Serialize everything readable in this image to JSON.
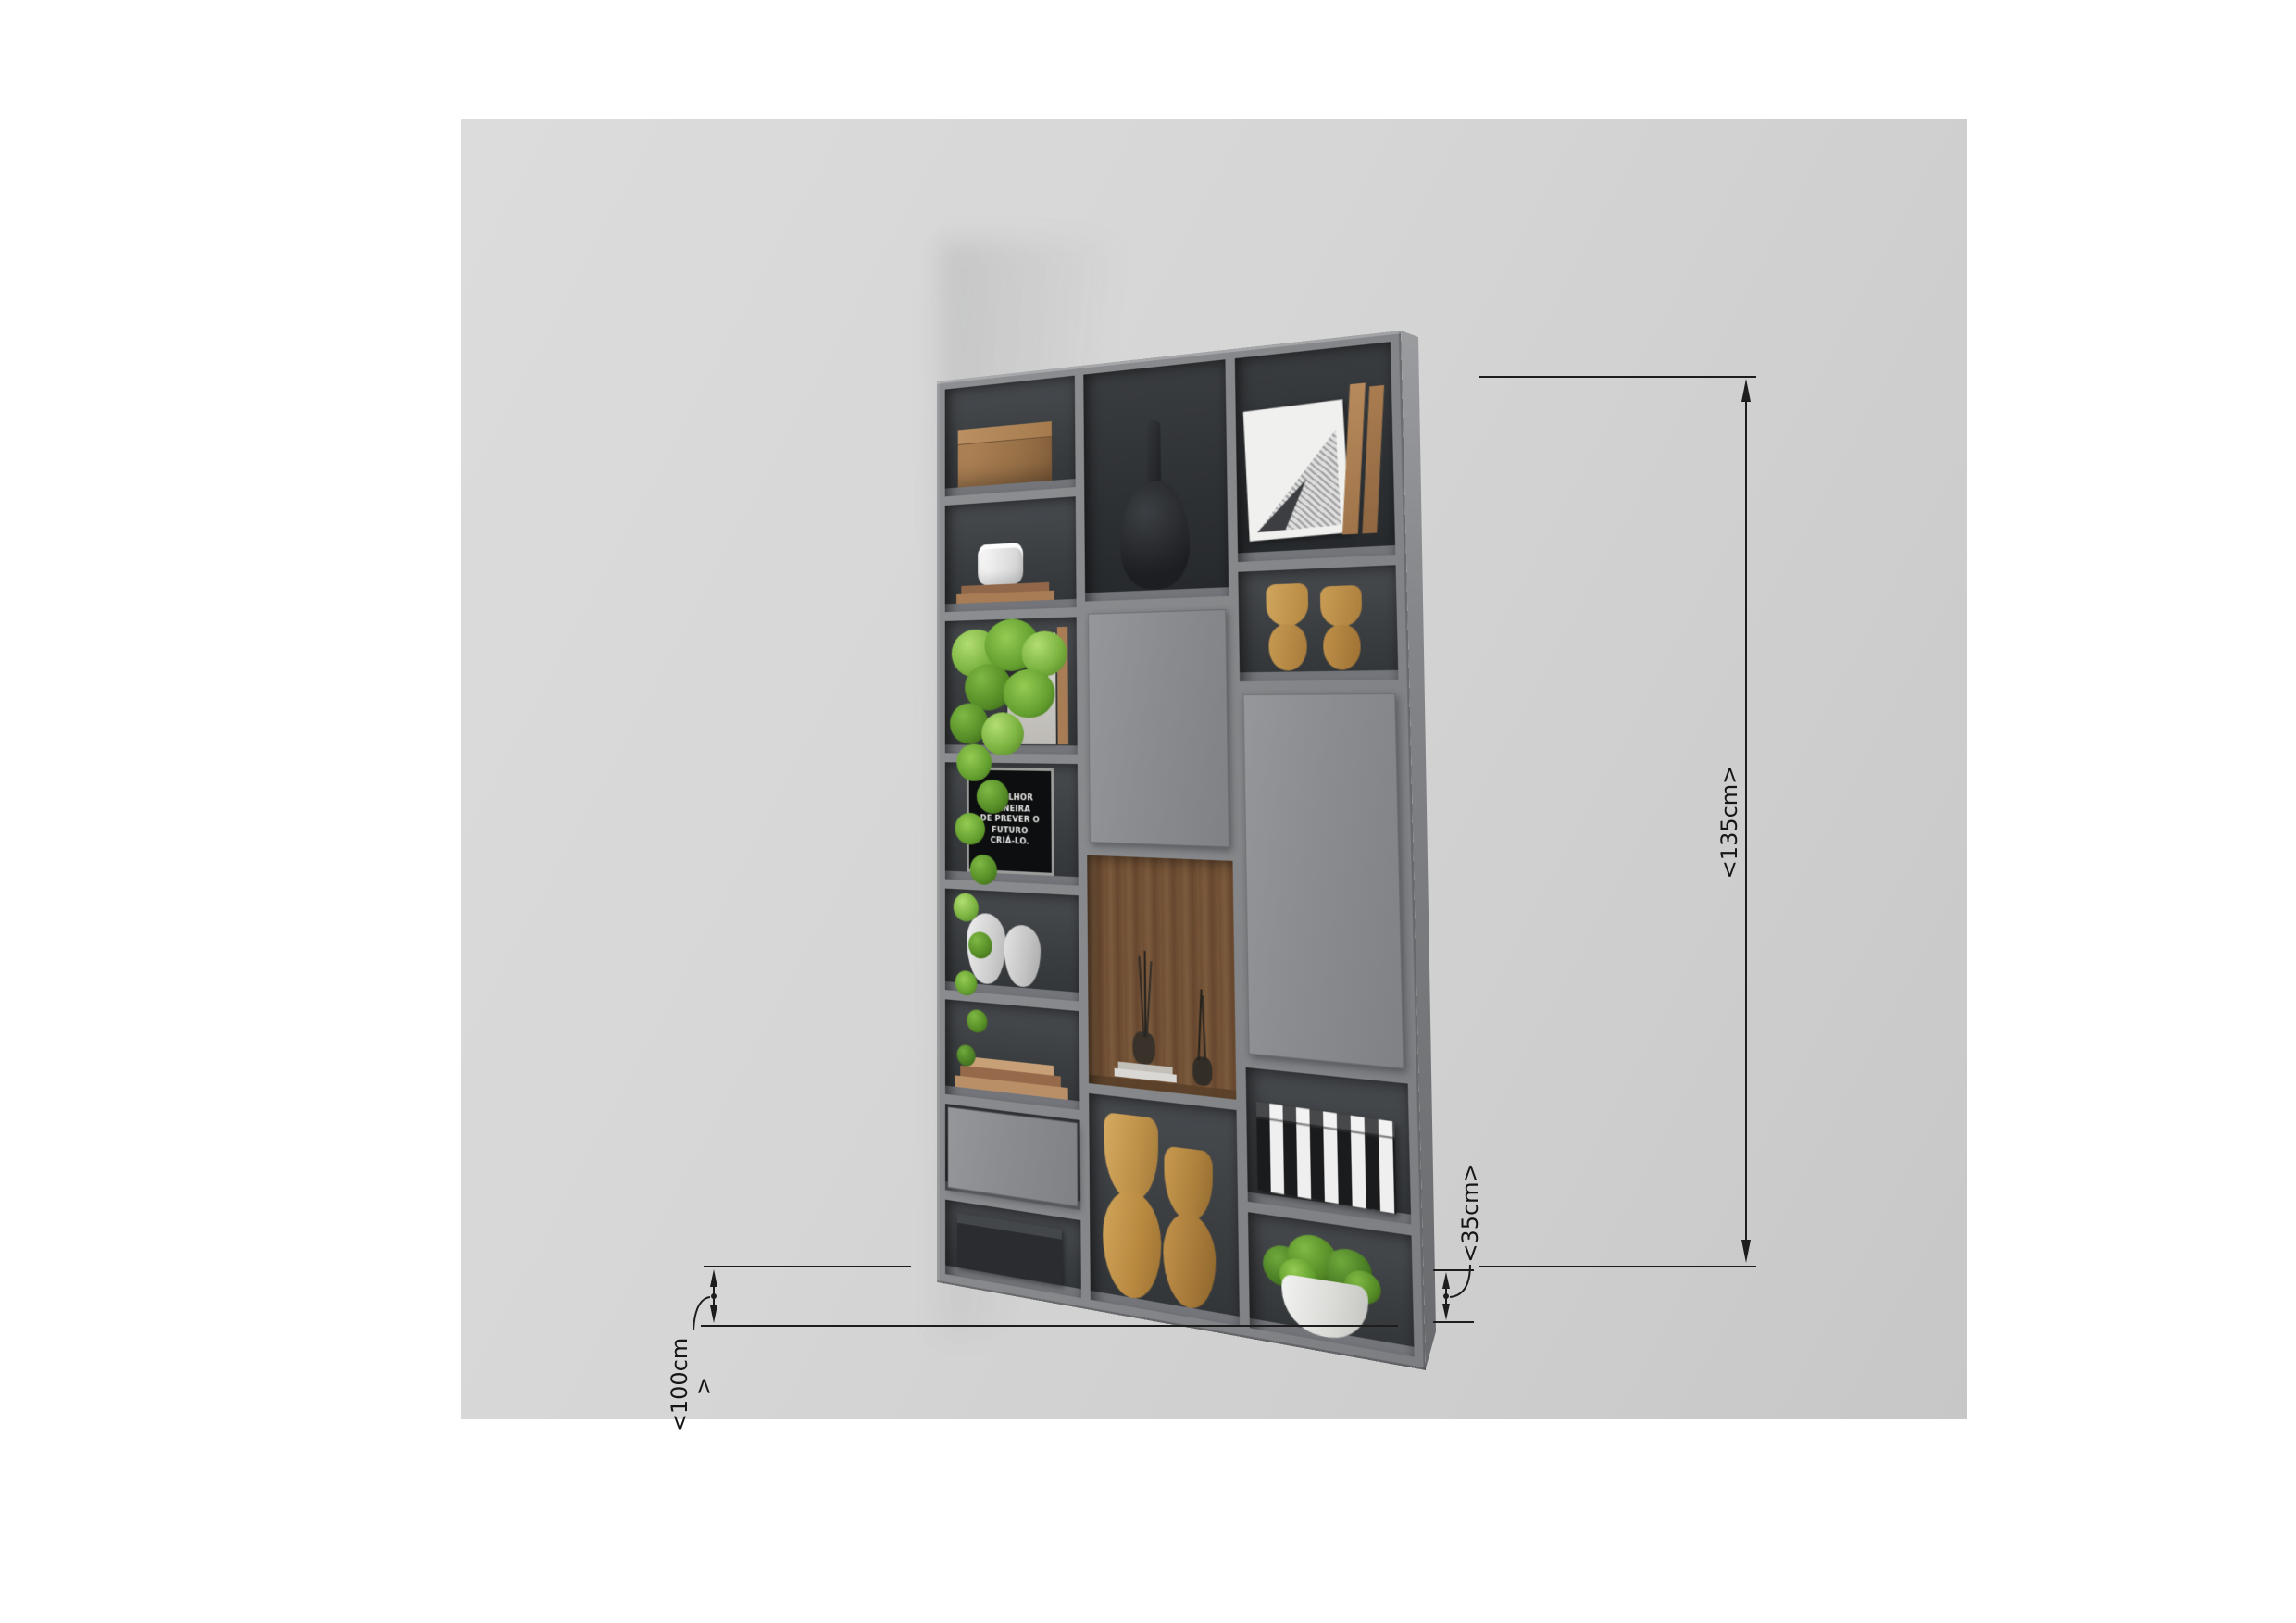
{
  "dimensions": {
    "height": "<135cm>",
    "depth": "<35cm>",
    "width": "<100cm",
    "width_arrow": ">"
  },
  "poster": {
    "line1": "A MELHOR MANEIRA",
    "line2": "DE PREVER O FUTURO",
    "line3": "CRIÁ-LO."
  },
  "colors": {
    "page_bg": "#ffffff",
    "canvas_bg": "#d6d6d6",
    "cabinet_frame": "#85878a",
    "cabinet_side": "#76787b",
    "compartment_dark": "#3a3d40",
    "door": "#8b8d90",
    "wood_niche": "#75533a",
    "dimension_ink": "#1d1d1d",
    "plant_green": "#7ab33e",
    "clay_tan": "#c49a55"
  },
  "cabinet": {
    "columns": [
      {
        "id": "left",
        "cells": [
          "wooden-box",
          "canister-on-books",
          "hanging-plant-with-frames",
          "quote-poster",
          "white-twisted-vases",
          "stacked-books",
          "closed-drawer",
          "black-storage-box"
        ]
      },
      {
        "id": "middle",
        "cells": [
          "black-bottle-vase",
          "closed-door",
          "wood-niche-with-twig-vases-and-books",
          "tall-clay-vases"
        ]
      },
      {
        "id": "right",
        "cells": [
          "framed-halftone-art-with-books",
          "clay-goblet-vases",
          "tall-closed-door",
          "striped-storage-box",
          "potted-green-plant"
        ]
      }
    ]
  }
}
